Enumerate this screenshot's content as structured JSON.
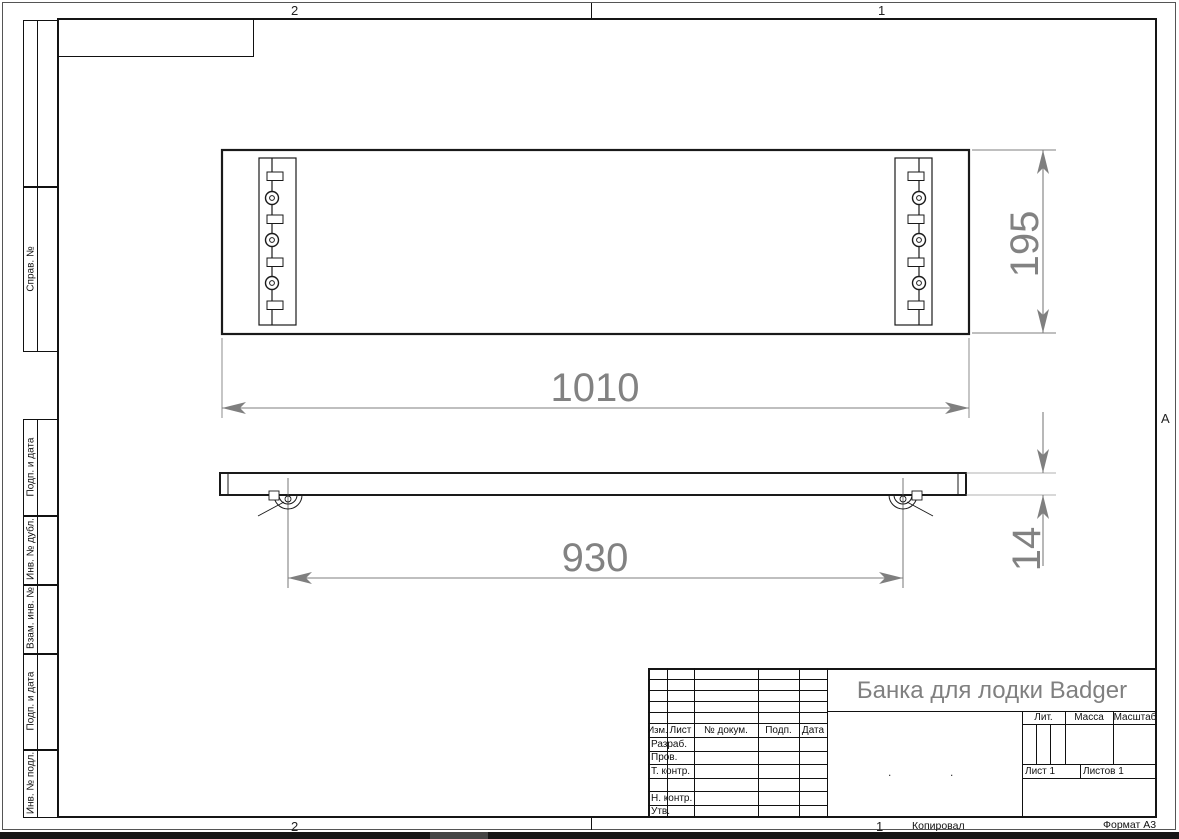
{
  "sheet": {
    "zone_top_left": "2",
    "zone_top_right": "1",
    "zone_bottom_left": "2",
    "zone_bottom_right": "1",
    "zone_right_letter": "А",
    "copied_label": "Копировал",
    "format_label": "Формат А3"
  },
  "side_stamps": {
    "sprav_label": "Справ. №",
    "lower": [
      "Подп. и дата",
      "Инв. № дубл.",
      "Взам. инв. №",
      "Подп. и дата",
      "Инв. № подл."
    ]
  },
  "title_block": {
    "title": "Банка для лодки Badger",
    "header_cols": [
      "Изм.",
      "Лист",
      "№ докум.",
      "Подп.",
      "Дата"
    ],
    "row_labels": [
      "Разраб.",
      "Пров.",
      "Т. контр.",
      "",
      "Н. контр.",
      "Утв."
    ],
    "lit_label": "Лит.",
    "mass_label": "Масса",
    "scale_label": "Масштаб",
    "sheet_label": "Лист 1",
    "sheets_label": "Листов 1",
    "dot": "."
  },
  "drawing": {
    "dims": {
      "width": "1010",
      "depth": "195",
      "mount_span": "930",
      "thickness": "14"
    }
  },
  "colors": {
    "line": "#1a1a1a",
    "dim": "#7f7f7f"
  }
}
